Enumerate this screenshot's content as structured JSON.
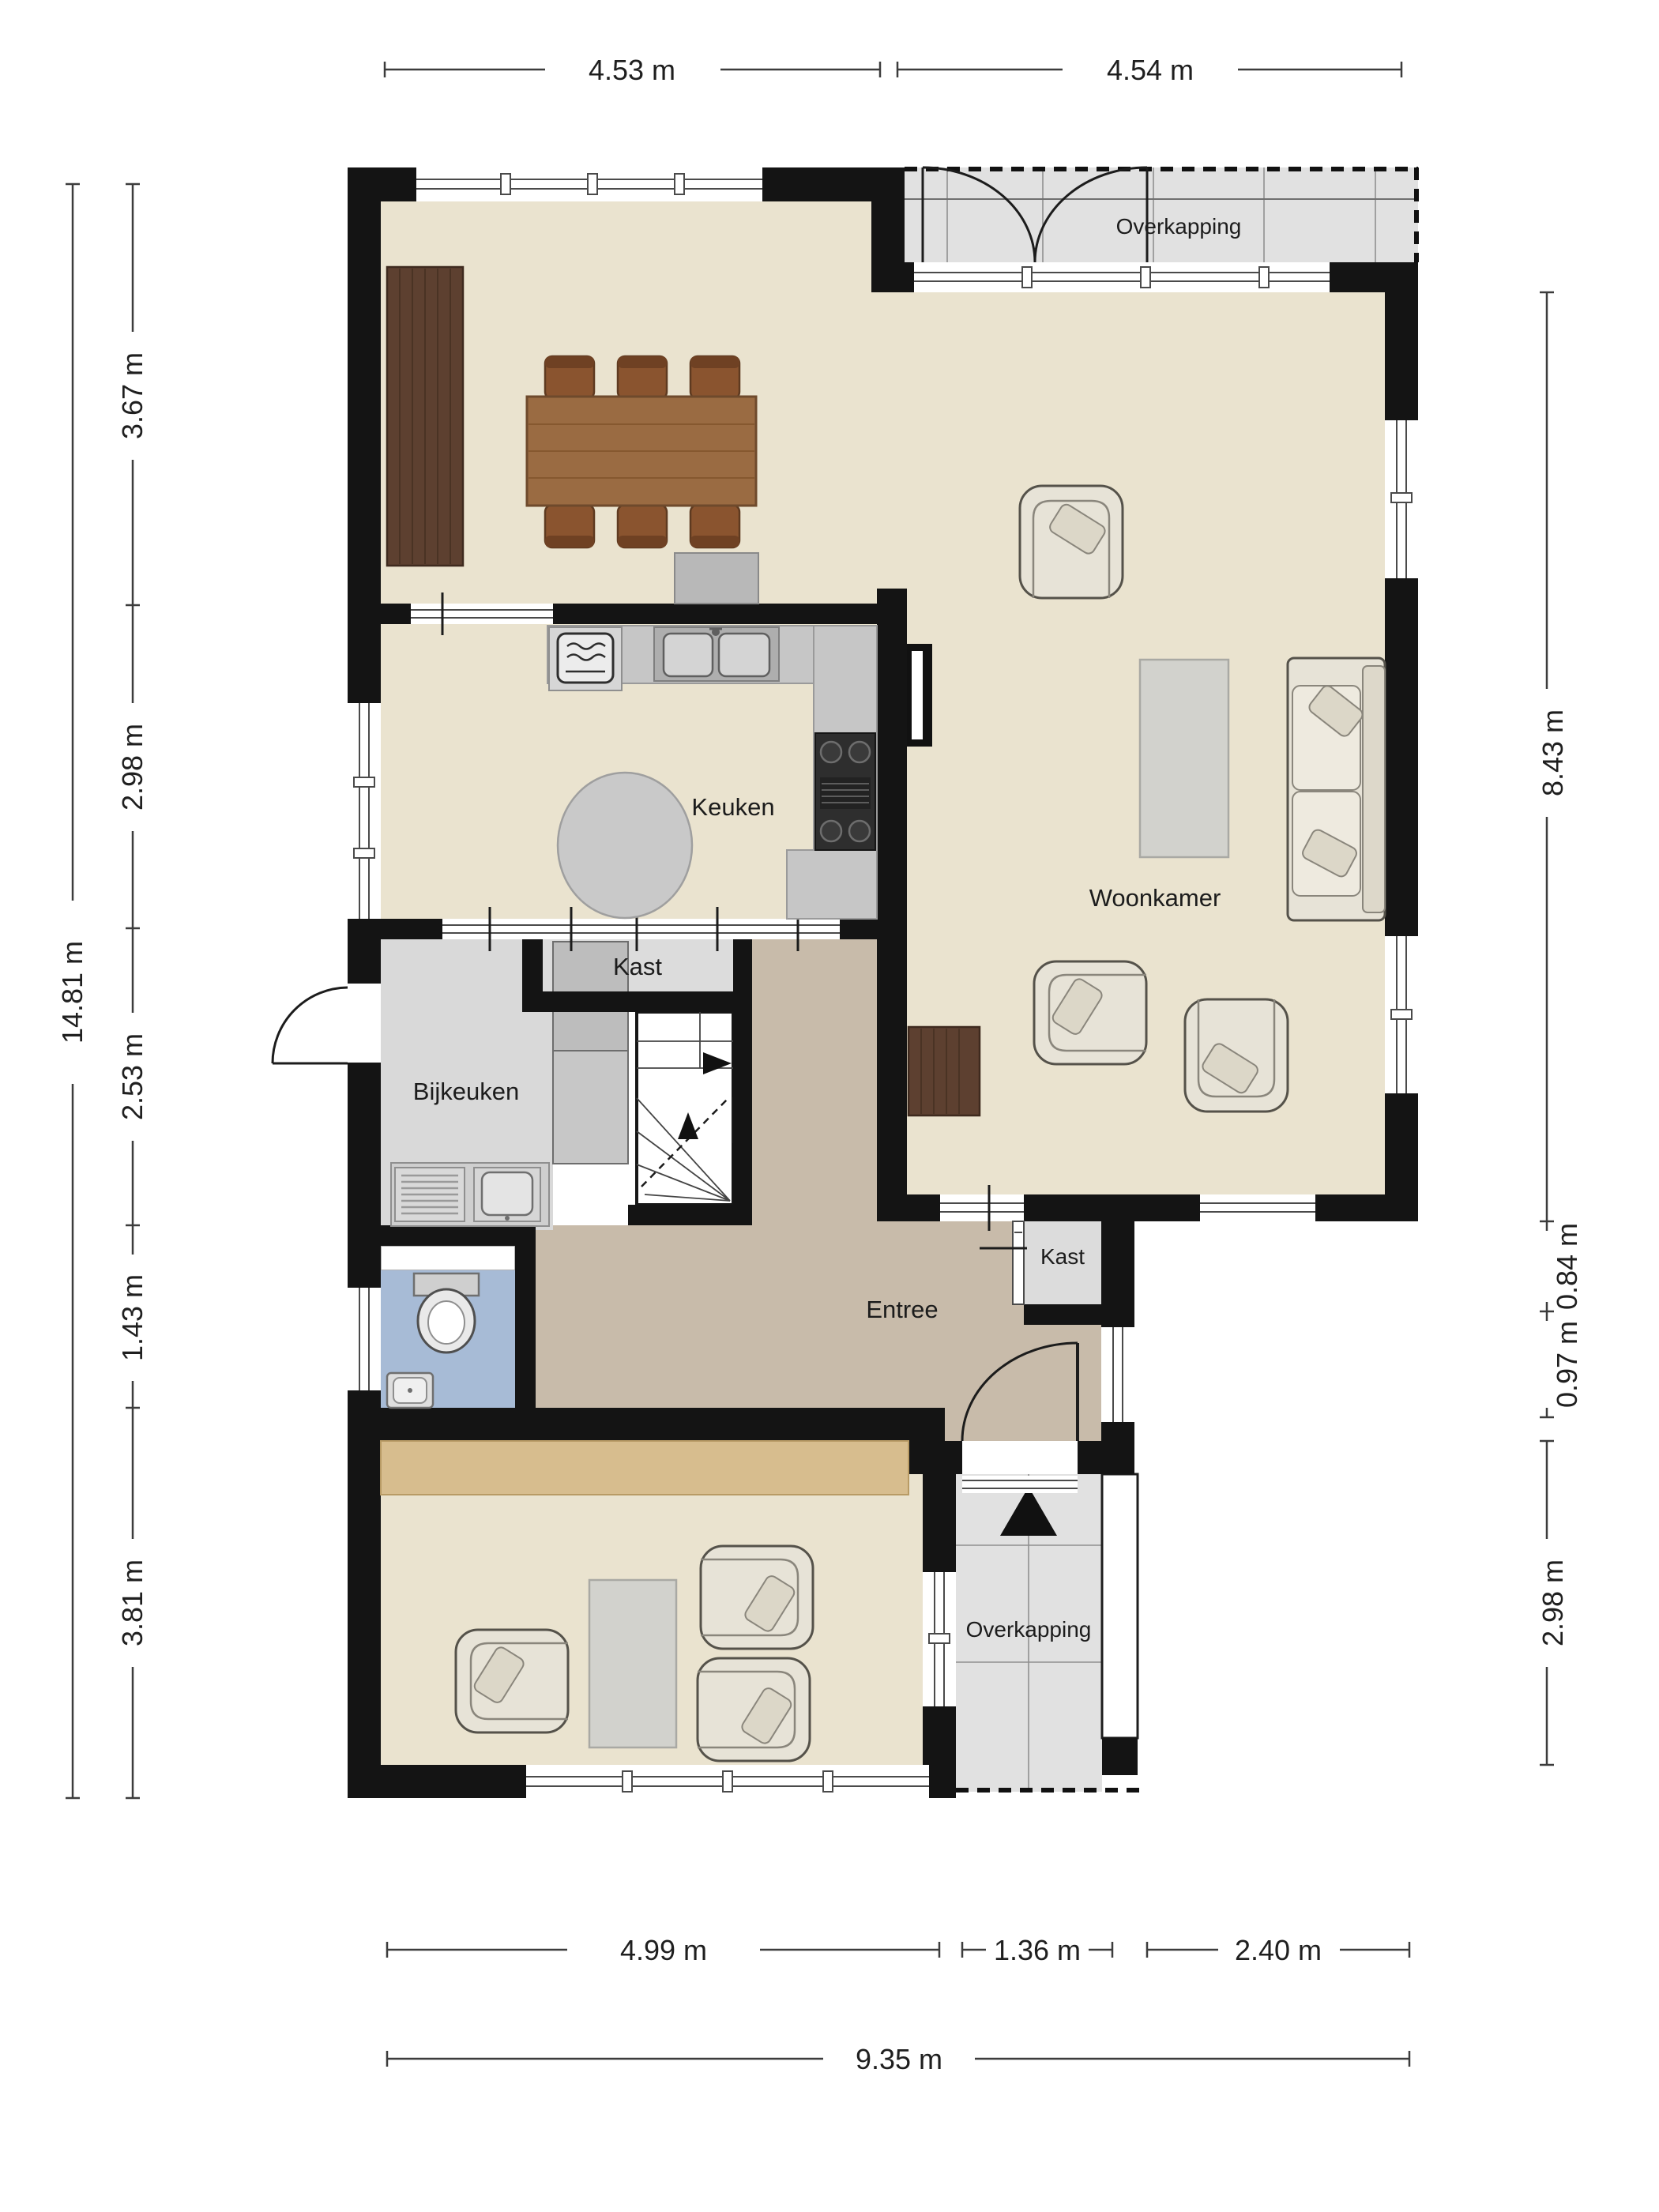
{
  "floorplan": {
    "rooms": {
      "keuken": {
        "label": "Keuken"
      },
      "woonkamer": {
        "label": "Woonkamer"
      },
      "bijkeuken": {
        "label": "Bijkeuken"
      },
      "entree": {
        "label": "Entree"
      },
      "kast_kitchen": {
        "label": "Kast"
      },
      "kast_entree": {
        "label": "Kast"
      },
      "overkapping_top": {
        "label": "Overkapping"
      },
      "overkapping_bottom": {
        "label": "Overkapping"
      }
    },
    "dimensions": {
      "top": [
        "4.53 m",
        "4.54 m"
      ],
      "left_overall": "14.81 m",
      "left_segments": [
        "3.67 m",
        "2.98 m",
        "2.53 m",
        "1.43 m",
        "3.81 m"
      ],
      "right_segments": [
        "8.43 m",
        "0.84 m",
        "0.97 m",
        "2.98 m"
      ],
      "bottom_segments": [
        "4.99 m",
        "1.36 m",
        "2.40 m"
      ],
      "bottom_overall": "9.35 m"
    },
    "colors": {
      "wall": "#141414",
      "floor_living": "#eae3cf",
      "floor_entree": "#c8bbaa",
      "floor_utility": "#d9d9d9",
      "floor_closet": "#dcdcdc",
      "floor_wc": "#a7bbd6",
      "canopy": "#e1e1e1",
      "wood_dark": "#5d4030",
      "wood_mid": "#9a6b42",
      "wood_light": "#d7bd8e",
      "furniture_cream": "#e7e3d7",
      "counter_gray": "#c6c6c6",
      "stove_dark": "#2e2e2e",
      "table_gray": "#d2d2cd"
    }
  }
}
